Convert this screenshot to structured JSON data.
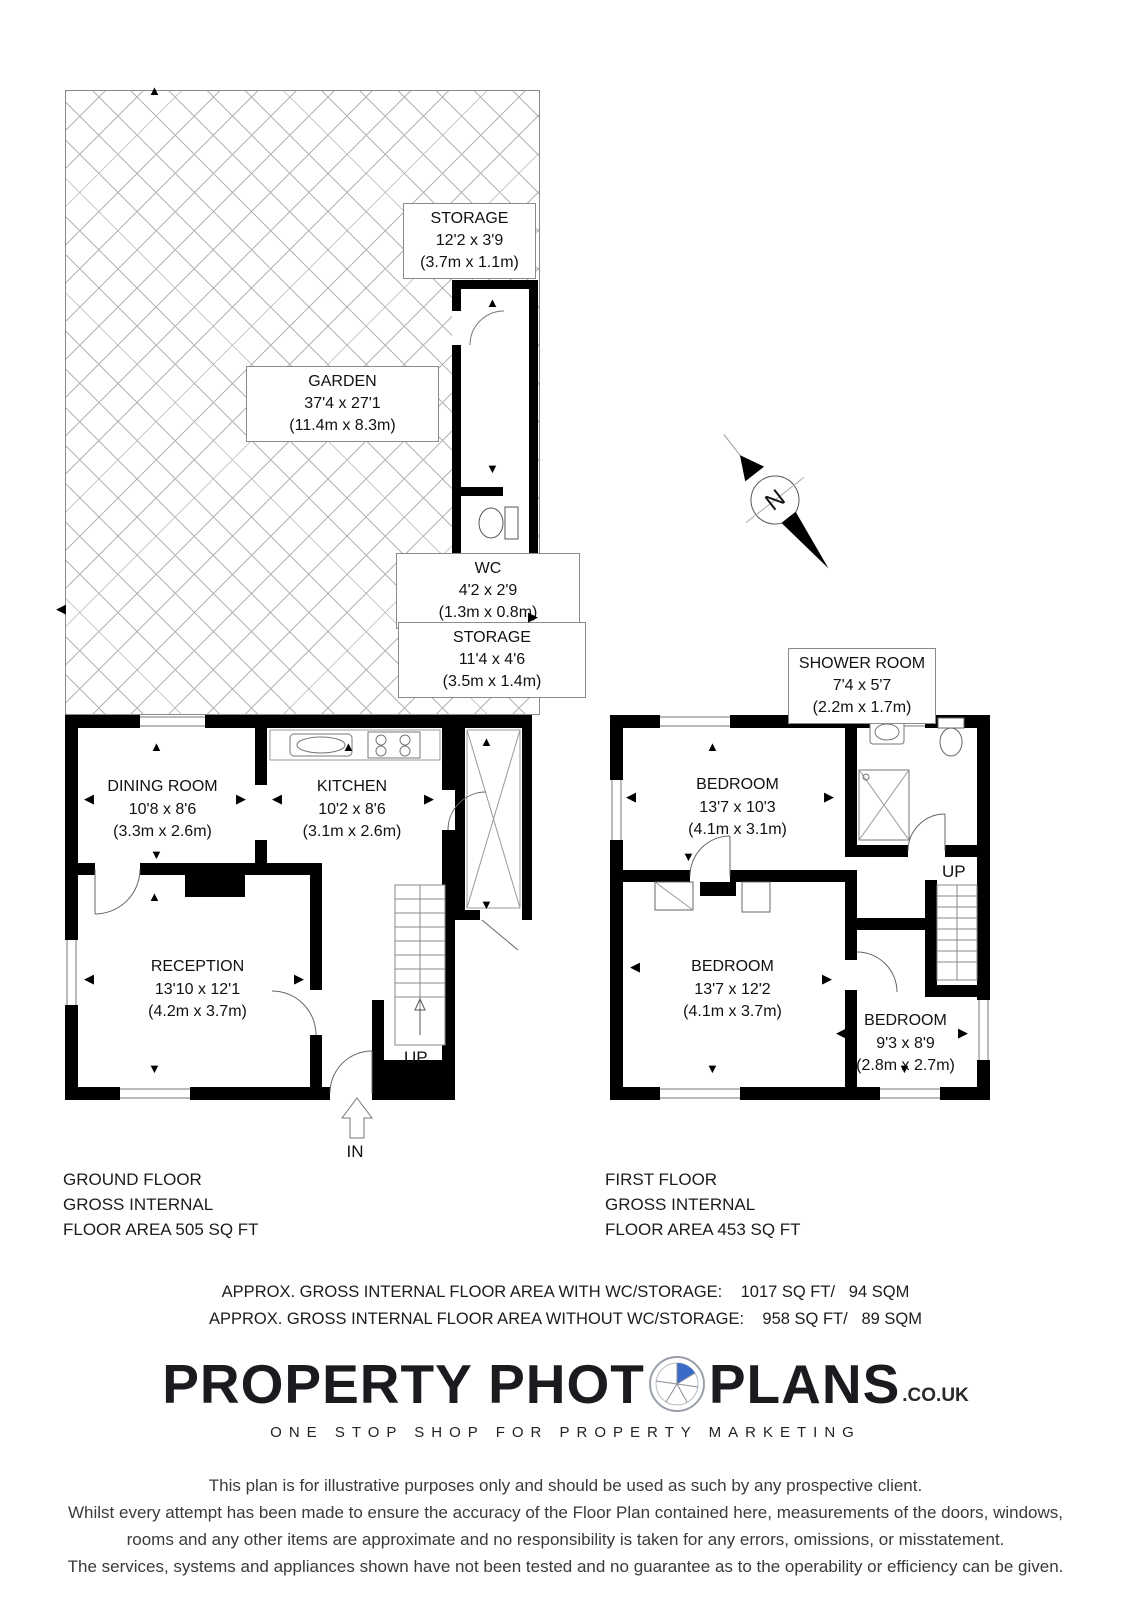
{
  "icons": {
    "up": "▲",
    "down": "▼",
    "left": "◀",
    "right": "▶"
  },
  "compass": {
    "label": "N"
  },
  "rooms": {
    "garden": {
      "name": "GARDEN",
      "imperial": "37'4 x 27'1",
      "metric": "(11.4m x 8.3m)"
    },
    "storage_outbuilding": {
      "name": "STORAGE",
      "imperial": "12'2 x 3'9",
      "metric": "(3.7m x 1.1m)"
    },
    "wc": {
      "name": "WC",
      "imperial": "4'2 x 2'9",
      "metric": "(1.3m x 0.8m)"
    },
    "storage_house": {
      "name": "STORAGE",
      "imperial": "11'4 x 4'6",
      "metric": "(3.5m x 1.4m)"
    },
    "dining_room": {
      "name": "DINING ROOM",
      "imperial": "10'8 x 8'6",
      "metric": "(3.3m x 2.6m)"
    },
    "kitchen": {
      "name": "KITCHEN",
      "imperial": "10'2 x 8'6",
      "metric": "(3.1m x 2.6m)"
    },
    "reception": {
      "name": "RECEPTION",
      "imperial": "13'10 x 12'1",
      "metric": "(4.2m x 3.7m)"
    },
    "shower_room": {
      "name": "SHOWER ROOM",
      "imperial": "7'4 x 5'7",
      "metric": "(2.2m x 1.7m)"
    },
    "bedroom_1": {
      "name": "BEDROOM",
      "imperial": "13'7 x 10'3",
      "metric": "(4.1m x 3.1m)"
    },
    "bedroom_2": {
      "name": "BEDROOM",
      "imperial": "13'7 x 12'2",
      "metric": "(4.1m x 3.7m)"
    },
    "bedroom_3": {
      "name": "BEDROOM",
      "imperial": "9'3 x 8'9",
      "metric": "(2.8m x 2.7m)"
    }
  },
  "stairs": {
    "ground_label": "UP",
    "first_label": "UP"
  },
  "entrance": {
    "label": "IN"
  },
  "floors": {
    "ground": {
      "lines": [
        "GROUND FLOOR",
        "GROSS INTERNAL",
        "FLOOR AREA 505 SQ FT"
      ]
    },
    "first": {
      "lines": [
        "FIRST FLOOR",
        "GROSS INTERNAL",
        "FLOOR AREA 453 SQ FT"
      ]
    }
  },
  "summary": {
    "line1": "APPROX. GROSS INTERNAL FLOOR AREA WITH WC/STORAGE:    1017 SQ FT/   94 SQM",
    "line2": "APPROX. GROSS INTERNAL FLOOR AREA WITHOUT WC/STORAGE:    958 SQ FT/   89 SQM"
  },
  "logo": {
    "part1": "PROPERTY PHOT",
    "part2": "PLANS",
    "suffix": ".CO.UK",
    "tagline": "ONE STOP SHOP FOR PROPERTY MARKETING",
    "accent_color": "#3a6bc9"
  },
  "disclaimer": {
    "lines": [
      "This plan is for illustrative purposes only and should be used as such by any prospective client.",
      "Whilst every attempt has been made to ensure the accuracy of the Floor Plan contained here, measurements of the doors, windows,",
      "rooms and any other items are approximate and no responsibility is taken for any errors, omissions, or misstatement.",
      "The services, systems and appliances shown have not been tested and no guarantee as to the operability or efficiency can be given."
    ]
  }
}
